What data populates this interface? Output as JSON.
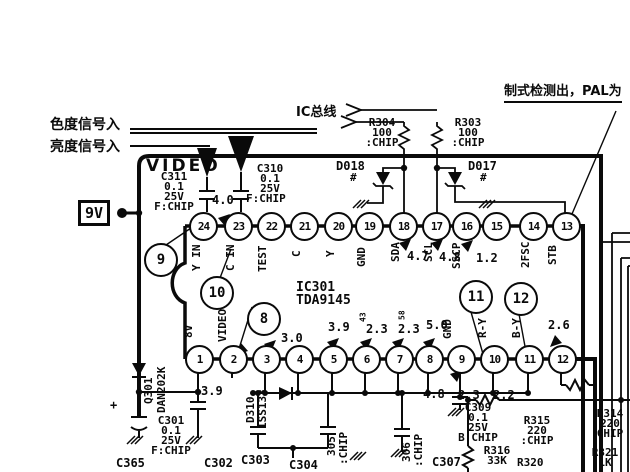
{
  "annotations": {
    "chroma_input": "色度信号入",
    "luma_input": "亮度信号入",
    "ic_bus": "IC总线",
    "system_detect": "制式检测出，PAL为",
    "video_section": "VIDEO",
    "supply": "9V"
  },
  "ic": {
    "ref_line": "IC301\nTDA9145",
    "top_pins": [
      {
        "num": "24",
        "name": "Y IN"
      },
      {
        "num": "23",
        "name": "C IN"
      },
      {
        "num": "22",
        "name": "TEST"
      },
      {
        "num": "21",
        "name": "C"
      },
      {
        "num": "20",
        "name": "Y"
      },
      {
        "num": "19",
        "name": "GND"
      },
      {
        "num": "18",
        "name": "SDA"
      },
      {
        "num": "17",
        "name": "SCL"
      },
      {
        "num": "16",
        "name": "SSCP"
      },
      {
        "num": "15",
        "name": ""
      },
      {
        "num": "14",
        "name": "2FSC"
      },
      {
        "num": "13",
        "name": "STB"
      }
    ],
    "bottom_pins": [
      {
        "num": "1",
        "name": "8V"
      },
      {
        "num": "2",
        "name": "VIDEO"
      },
      {
        "num": "3",
        "name": ""
      },
      {
        "num": "4",
        "name": ""
      },
      {
        "num": "5",
        "name": ""
      },
      {
        "num": "6",
        "name": ""
      },
      {
        "num": "7",
        "name": ""
      },
      {
        "num": "8",
        "name": ""
      },
      {
        "num": "9",
        "name": "GND"
      },
      {
        "num": "10",
        "name": "R-Y"
      },
      {
        "num": "11",
        "name": "B-Y"
      },
      {
        "num": "12",
        "name": ""
      }
    ]
  },
  "callouts": {
    "c8": "8",
    "c9": "9",
    "c10": "10",
    "c11": "11",
    "c12": "12"
  },
  "voltages": {
    "pin23_in": "4.0",
    "pin18": "4.7",
    "pin17": "4.8",
    "pin16": "1.2",
    "pin12": "2.6",
    "pin2": "3.9",
    "pin4": "3.0",
    "pin5": "3.9",
    "pin6": "2.3",
    "pin7": "2.3",
    "pin8": "5.0",
    "pin6_small": "43",
    "pin7_small": "58",
    "below8": "4.8",
    "below9": "2.3",
    "below10": "2.2"
  },
  "components": {
    "c311": "C311\n0.1\n25V\nF:CHIP",
    "c310": "C310\n0.1\n25V",
    "c310_type": "F:CHIP",
    "r304": "R304\n100\n:CHIP",
    "r303": "R303\n100\n:CHIP",
    "d018": "D018",
    "d017": "D017",
    "zener_mark": "#",
    "q301": "Q301",
    "q301_part": "DAN202K",
    "d310": "D310",
    "d310_part": "1SS133",
    "c301": "C301\n0.1\n25V\nF:CHIP",
    "c365": "C365",
    "c365_plus": "+",
    "c302": "C302",
    "c303": "C303",
    "c304": "C304",
    "c305": "305",
    "c305_type": ":CHIP",
    "c306": "306",
    "c306_type": ":CHIP",
    "c307": "C307",
    "c309": "C309\n0.1\n25V\nB:CHIP",
    "r315": "R315\n220\n:CHIP",
    "r314": "R314\n220\nCHIP",
    "r316": "R316\n33K",
    "r320": "R320",
    "r321": "R321\n1K"
  }
}
